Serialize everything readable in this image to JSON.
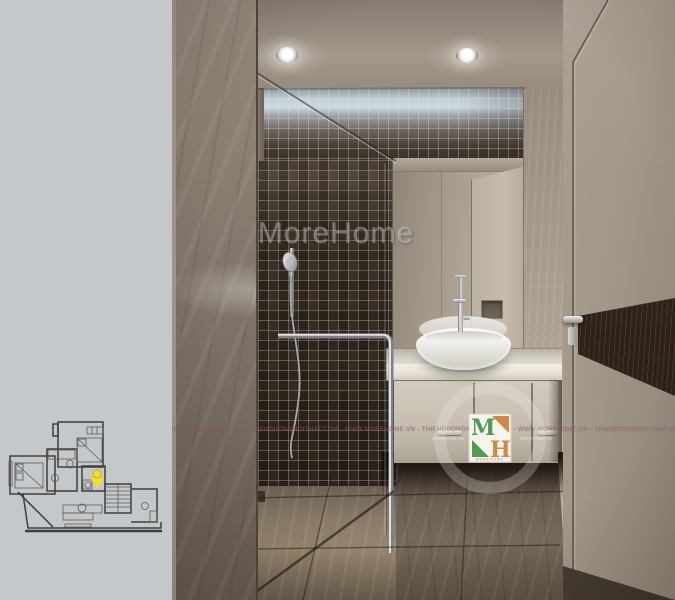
{
  "page": {
    "background": "#c5c8ca"
  },
  "render": {
    "subject": "bathroom-interior-render",
    "watermark_text": "MoreHome",
    "watermark_strip_text": "WWW.MOREHOME.VN - THIENDUONGNOITHAT.COM - WWW.MOREHOME.VN - THIENDUONGNOITHAT.COM - WWW.MOREHOME.VN - THIENDUONGNOITHAT.COM - WWW.MOREHOME.VN - THIENDUONGNOITHAT.COM - WWW.MOREHOME.VN - THIENDUONGNOITHAT.COM",
    "logo": {
      "letter_m": "M",
      "letter_h": "H",
      "subtext": "MOREHOME",
      "side_text_left": "MOREHOME.VN",
      "side_text_right": "MOREHOME.VN",
      "green": "#4f9c55",
      "orange": "#cc8a45"
    }
  },
  "floor_plan": {
    "marker_color": "#f4e11d",
    "marker_stroke": "#c9a40d",
    "line_color": "#3e3e3e"
  },
  "palette": {
    "mosaic_dark": "#342b23",
    "marble_taupe": "#7e7368",
    "floor_brown": "#6b5d4f",
    "door_greige": "#a09685",
    "counter_white": "#ece9e1",
    "chrome": "#d5d7d8",
    "cove_glow": "#ccd7de"
  }
}
